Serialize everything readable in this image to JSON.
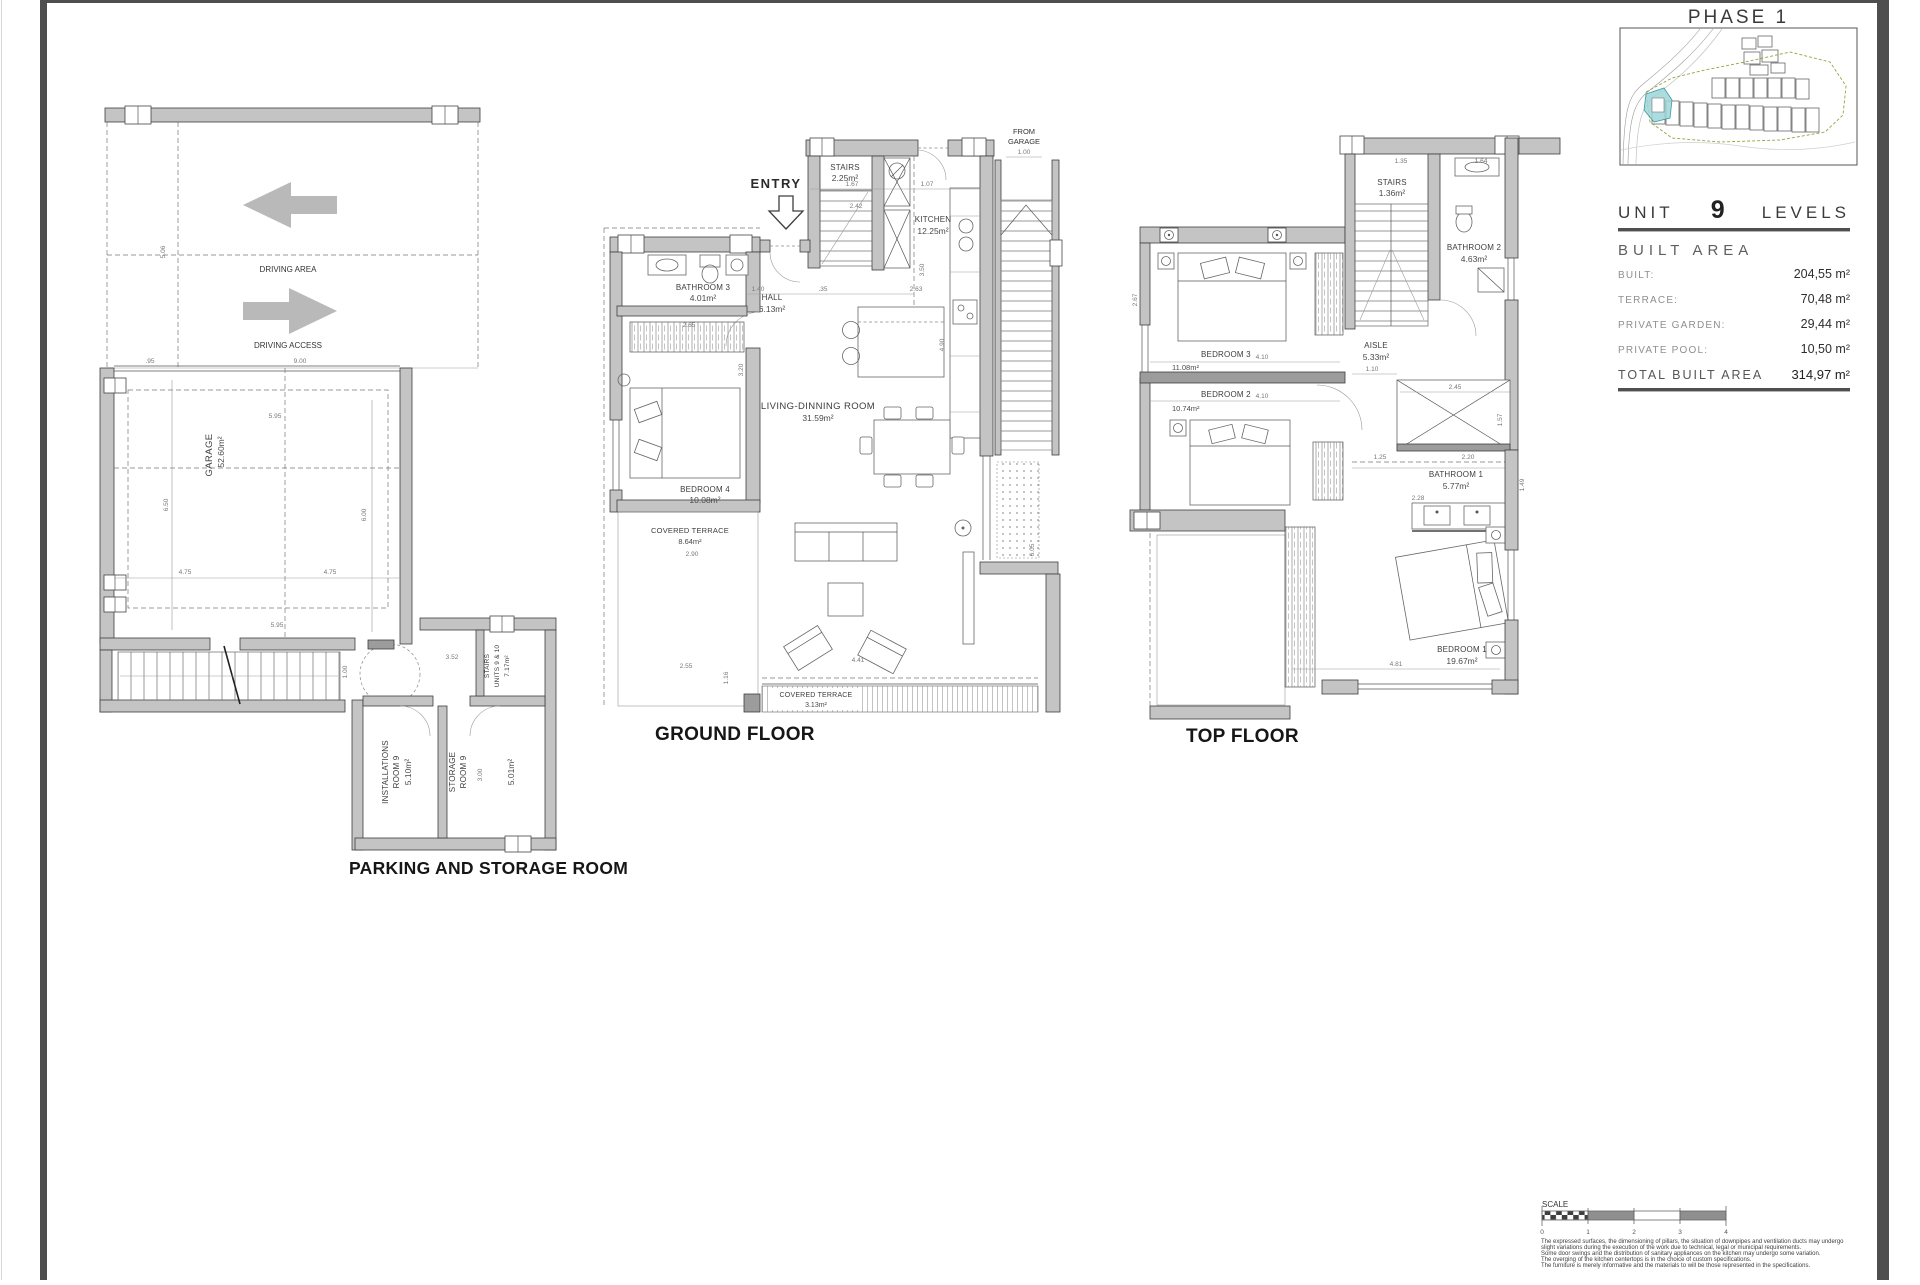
{
  "phase": {
    "title": "PHASE 1"
  },
  "unit_panel": {
    "unit": "UNIT",
    "number": "9",
    "levels": "LEVELS",
    "built_area_heading": "BUILT AREA",
    "rows": [
      {
        "label": "BUILT:",
        "value": "204,55 m²"
      },
      {
        "label": "TERRACE:",
        "value": "70,48 m²"
      },
      {
        "label": "PRIVATE GARDEN:",
        "value": "29,44 m²"
      },
      {
        "label": "PRIVATE POOL:",
        "value": "10,50 m²"
      }
    ],
    "total_label": "TOTAL BUILT AREA",
    "total_value": "314,97 m²"
  },
  "parking": {
    "title": "PARKING AND STORAGE ROOM",
    "driving_area": "DRIVING AREA",
    "driving_access": "DRIVING ACCESS",
    "garage": {
      "name": "GARAGE",
      "area": "52.60m²"
    },
    "installations": {
      "l1": "INSTALLATIONS",
      "l2": "ROOM 9",
      "area": "5.10m²"
    },
    "storage": {
      "l1": "STORAGE",
      "l2": "ROOM 9",
      "area": "5.01m²"
    },
    "stairs_units": {
      "l1": "STAIRS",
      "l2": "UNITS 9 & 10",
      "area": "7.17m²"
    },
    "dims": [
      "5.06",
      ".95",
      "9.00",
      "5.95",
      "6.50",
      "6.00",
      "4.75",
      "4.75",
      "5.95",
      "3.52",
      "3.00",
      "1.00"
    ]
  },
  "ground": {
    "title": "GROUND FLOOR",
    "entry": "ENTRY",
    "from_garage_1": "FROM",
    "from_garage_2": "GARAGE",
    "rooms": {
      "stairs": {
        "name": "STAIRS",
        "area": "2.25m²"
      },
      "kitchen": {
        "name": "KITCHEN",
        "area": "12.25m²"
      },
      "hall": {
        "name": "HALL",
        "area": "6.13m²"
      },
      "bathroom3": {
        "name": "BATHROOM 3",
        "area": "4.01m²"
      },
      "bedroom4": {
        "name": "BEDROOM 4",
        "area": "10.08m²"
      },
      "living": {
        "name": "LIVING-DINNING ROOM",
        "area": "31.59m²"
      },
      "terrace_side": {
        "name": "COVERED TERRACE",
        "area": "8.64m²"
      },
      "terrace_front": {
        "name": "COVERED TERRACE",
        "area": "3.13m²"
      }
    },
    "dims": [
      "1.00",
      "1.67",
      "1.07",
      "2.42",
      "4.90",
      "1.40",
      ".35",
      "2.63",
      "2.65",
      "2.90",
      "2.55",
      "1.16",
      "4.41",
      "3.50",
      "6.05",
      "3.20"
    ]
  },
  "top": {
    "title": "TOP FLOOR",
    "rooms": {
      "stairs": {
        "name": "STAIRS",
        "area": "1.36m²"
      },
      "bathroom2": {
        "name": "BATHROOM 2",
        "area": "4.63m²"
      },
      "aisle": {
        "name": "AISLE",
        "area": "5.33m²"
      },
      "bedroom3": {
        "name": "BEDROOM 3",
        "area": "11.08m²"
      },
      "bedroom2": {
        "name": "BEDROOM 2",
        "area": "10.74m²"
      },
      "bathroom1": {
        "name": "BATHROOM 1",
        "area": "5.77m²"
      },
      "bedroom1": {
        "name": "BEDROOM 1",
        "area": "19.67m²"
      }
    },
    "dims": [
      "1.35",
      "1.64",
      "4.10",
      "4.10",
      "2.45",
      "1.10",
      "2.67",
      "2.20",
      "1.25",
      "2.28",
      "4.81",
      "1.49",
      "1.57"
    ]
  },
  "scale_legend": {
    "label": "SCALE",
    "ticks": [
      "0",
      "1",
      "2",
      "3",
      "4"
    ]
  },
  "disclaimer": {
    "lines": [
      "The expressed surfaces, the dimensioning of pillars, the situation of downpipes and ventilation ducts may undergo",
      "slight variations during the execution of the work due to technical, legal or municipal requirements.",
      "Some door swings and the distribution of sanitary appliances on the kitchen may undergo some variation.",
      "The overging of the kitchen centertops is in the choice of custom specifications.",
      "The furniture is merely informative and the materials to will be those represented in the specifications."
    ]
  },
  "colors": {
    "wall": "#c4c4c4",
    "edge_bar": "#4e4e4e",
    "highlight_cyan": "#9fd6d9",
    "boundary_olive": "#9aa03f"
  }
}
